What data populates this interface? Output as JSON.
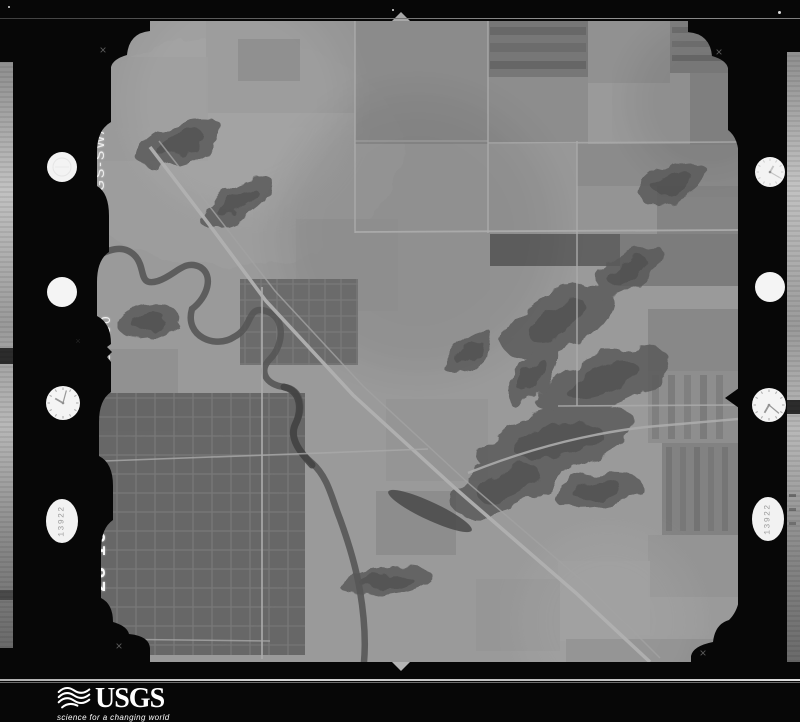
{
  "film": {
    "photo_id": "GS-SWA1",
    "frame_number": "5 130",
    "date": "APR 28 1966",
    "counter_left": "13922",
    "counter_right": "13922",
    "fiducial_mark": "×"
  },
  "logo": {
    "wordmark": "USGS",
    "tagline": "science for a changing world"
  },
  "colors": {
    "film_black": "#070707",
    "photo_base": "#b9b9b9",
    "logo_text": "#ffffff"
  },
  "terrain": {
    "fields": [
      [
        267,
        0,
        133,
        123,
        "#aeaeae"
      ],
      [
        400,
        0,
        100,
        56,
        "#909090"
      ],
      [
        500,
        0,
        82,
        62,
        "#b7b7b7"
      ],
      [
        582,
        0,
        68,
        52,
        "#9d9d9d"
      ],
      [
        540,
        62,
        62,
        46,
        "#c4c4c4"
      ],
      [
        400,
        56,
        100,
        67,
        "#b1b1b1"
      ],
      [
        602,
        52,
        48,
        72,
        "#aaaaaa"
      ],
      [
        400,
        123,
        89,
        90,
        "#c2c2c2"
      ],
      [
        489,
        123,
        161,
        42,
        "#aeaeae"
      ],
      [
        489,
        165,
        80,
        48,
        "#bcbcbc"
      ],
      [
        569,
        165,
        81,
        48,
        "#a3a3a3"
      ],
      [
        402,
        213,
        130,
        32,
        "#6f6f6f"
      ],
      [
        532,
        213,
        118,
        52,
        "#979797"
      ],
      [
        402,
        245,
        86,
        72,
        "#c5c5c5"
      ],
      [
        560,
        288,
        90,
        62,
        "#a8a8a8"
      ],
      [
        560,
        350,
        90,
        72,
        "#b2b2b2"
      ],
      [
        574,
        422,
        76,
        92,
        "#a1a1a1"
      ],
      [
        560,
        514,
        90,
        62,
        "#bbbbbb"
      ],
      [
        470,
        540,
        92,
        80,
        "#c7c7c7"
      ],
      [
        388,
        558,
        84,
        72,
        "#bebebe"
      ],
      [
        478,
        618,
        172,
        23,
        "#b3b3b3"
      ],
      [
        118,
        0,
        149,
        92,
        "#bdbdbd"
      ],
      [
        150,
        18,
        62,
        42,
        "#a7a7a7"
      ],
      [
        0,
        328,
        90,
        82,
        "#b6b6b6"
      ],
      [
        288,
        470,
        80,
        64,
        "#b0b0b0"
      ],
      [
        298,
        378,
        102,
        82,
        "#bdbdbd"
      ],
      [
        208,
        198,
        102,
        92,
        "#c0c0c0"
      ],
      [
        0,
        36,
        120,
        104,
        "#c3c3c3"
      ]
    ],
    "stripe_fields": [
      [
        402,
        6,
        96,
        8,
        "#7d7d7d"
      ],
      [
        402,
        22,
        96,
        9,
        "#838383"
      ],
      [
        402,
        40,
        96,
        8,
        "#797979"
      ],
      [
        584,
        6,
        64,
        6,
        "#868686"
      ],
      [
        584,
        20,
        64,
        6,
        "#8c8c8c"
      ],
      [
        584,
        34,
        64,
        6,
        "#828282"
      ],
      [
        564,
        354,
        7,
        64,
        "#9b9b9b"
      ],
      [
        580,
        354,
        7,
        64,
        "#979797"
      ],
      [
        596,
        354,
        7,
        64,
        "#9e9e9e"
      ],
      [
        612,
        354,
        7,
        64,
        "#959595"
      ],
      [
        628,
        354,
        7,
        64,
        "#9c9c9c"
      ],
      [
        578,
        426,
        6,
        84,
        "#8f8f8f"
      ],
      [
        592,
        426,
        6,
        84,
        "#949494"
      ],
      [
        606,
        426,
        6,
        84,
        "#8b8b8b"
      ],
      [
        620,
        426,
        6,
        84,
        "#939393"
      ],
      [
        634,
        426,
        6,
        84,
        "#8e8e8e"
      ]
    ],
    "soft_spots": [
      [
        150,
        80,
        110,
        "#ffffff",
        0.16
      ],
      [
        90,
        520,
        90,
        "#ffffff",
        0.14
      ],
      [
        330,
        210,
        140,
        "#000000",
        0.06
      ],
      [
        520,
        600,
        90,
        "#ffffff",
        0.12
      ],
      [
        620,
        80,
        80,
        "#000000",
        0.07
      ]
    ],
    "towns": [
      {
        "x": 5,
        "y": 372,
        "w": 212,
        "h": 262,
        "base": "#9e9e9e",
        "street": "#d8d8d8",
        "spacing": 19
      },
      {
        "x": 152,
        "y": 258,
        "w": 118,
        "h": 86,
        "base": "#adadad",
        "street": "#dcdcdc",
        "spacing": 16
      }
    ],
    "woods_color": "#6f6f6f",
    "woods": [
      [
        470,
        300,
        60,
        28,
        -30
      ],
      [
        515,
        360,
        70,
        26,
        -20
      ],
      [
        470,
        420,
        80,
        30,
        -15
      ],
      [
        420,
        462,
        60,
        26,
        -25
      ],
      [
        540,
        250,
        40,
        16,
        -35
      ],
      [
        380,
        330,
        30,
        14,
        -40
      ],
      [
        298,
        560,
        46,
        13,
        -8
      ],
      [
        150,
        182,
        42,
        18,
        -30
      ],
      [
        92,
        122,
        46,
        20,
        -20
      ],
      [
        585,
        162,
        36,
        17,
        -25
      ],
      [
        445,
        355,
        36,
        16,
        -50
      ],
      [
        510,
        470,
        44,
        18,
        -10
      ],
      [
        60,
        300,
        30,
        16,
        -15
      ]
    ],
    "river": {
      "d": "M0,240 C20,228 36,222 48,236 C58,248 50,266 70,260 C88,254 96,238 112,246 C126,254 120,276 104,288 C96,316 128,328 146,316 C166,306 158,284 178,290 C198,296 196,324 182,338 C170,350 178,364 196,366 C214,368 216,388 208,402 C200,416 212,432 224,442 C240,456 244,478 252,498 C260,520 268,546 272,570 C276,594 278,618 276,641",
      "w": 6.5,
      "c": "#6a6a6a",
      "o": 0.9
    },
    "river_dark": {
      "d": "M196,366 C214,370 214,390 207,404 C201,418 213,432 224,444",
      "w": 7,
      "c": "#4f4f4f",
      "o": 0.85
    },
    "pond": {
      "cx": 342,
      "cy": 490,
      "rx": 46,
      "ry": 9,
      "rot": 25,
      "c": "#585858"
    },
    "roads": [
      {
        "d": "M62,126 L120,202 L178,280 L265,374 L368,468 L488,572 L562,641",
        "w": 3.5,
        "c": "#e3e3e3",
        "o": 0.95
      },
      {
        "d": "M71,120 L187,270 L275,365 L378,460 L498,563 L572,637",
        "w": 1.5,
        "c": "#cfcfcf",
        "o": 0.8
      },
      {
        "d": "M380,452 Q470,416 558,406 L650,398",
        "w": 2.4,
        "c": "#dcdcdc",
        "o": 0.9
      },
      {
        "d": "M267,0 L267,212",
        "w": 1.6,
        "c": "#dadada",
        "o": 0.85
      },
      {
        "d": "M400,0 L400,212",
        "w": 1.6,
        "c": "#dadada",
        "o": 0.85
      },
      {
        "d": "M489,120 L489,385",
        "w": 1.6,
        "c": "#dadada",
        "o": 0.85
      },
      {
        "d": "M267,211 L650,209",
        "w": 1.8,
        "c": "#dedede",
        "o": 0.9
      },
      {
        "d": "M400,122 L650,121",
        "w": 1.6,
        "c": "#dadada",
        "o": 0.85
      },
      {
        "d": "M470,385 L650,384",
        "w": 1.6,
        "c": "#dadada",
        "o": 0.85
      },
      {
        "d": "M174,266 L174,638",
        "w": 1.8,
        "c": "#dcdcdc",
        "o": 0.9
      },
      {
        "d": "M16,440 L340,428",
        "w": 1.6,
        "c": "#d8d8d8",
        "o": 0.8
      },
      {
        "d": "M8,618 L182,620",
        "w": 1.5,
        "c": "#d6d6d6",
        "o": 0.8
      },
      {
        "d": "M267,120 L400,120",
        "w": 1.3,
        "c": "#d6d6d6",
        "o": 0.7
      }
    ]
  }
}
